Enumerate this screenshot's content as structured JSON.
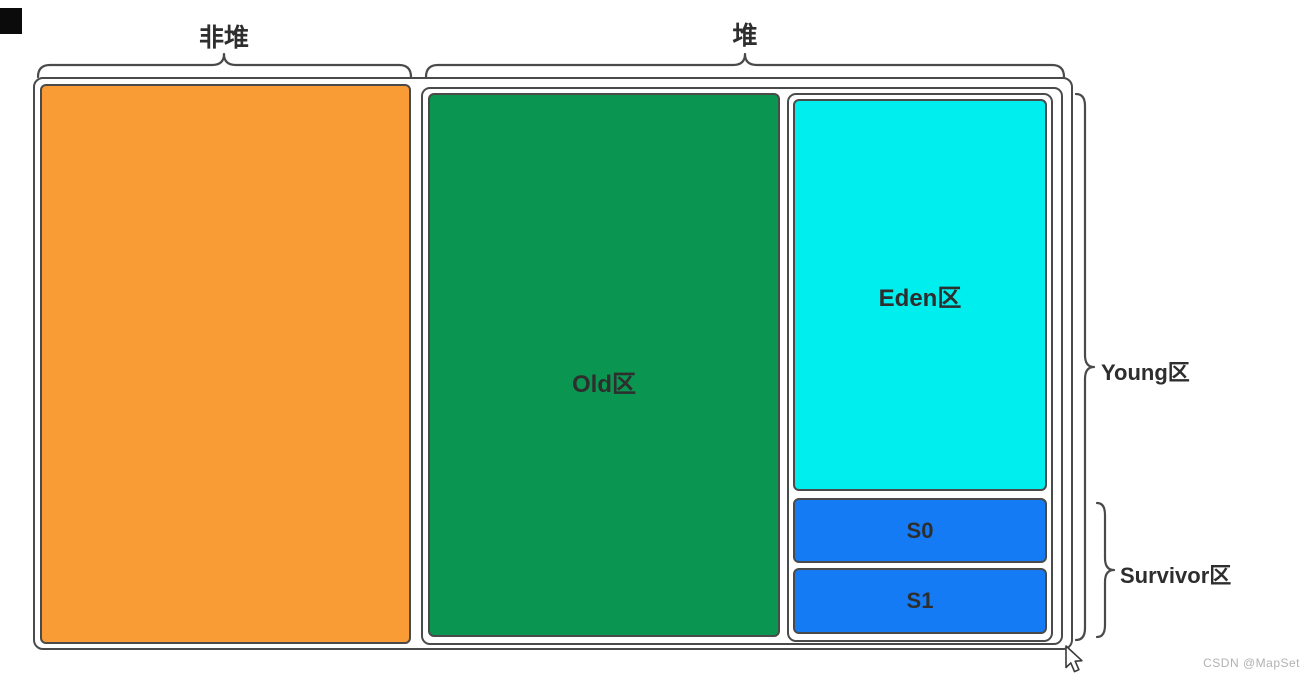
{
  "diagram": {
    "title_semantics": "JVM memory structure diagram",
    "top_braces": {
      "non_heap_label": "非堆",
      "heap_label": "堆"
    },
    "regions": {
      "old_label": "Old区",
      "eden_label": "Eden区",
      "s0_label": "S0",
      "s1_label": "S1"
    },
    "side_braces": {
      "young_label": "Young区",
      "survivor_label": "Survivor区"
    },
    "watermark": "CSDN @MapSet",
    "colors": {
      "non_heap_fill": "#FA9C36",
      "old_fill": "#0A9550",
      "eden_fill": "#00EEEE",
      "survivor_fill": "#157BF5",
      "container_fill": "#FFFFFF",
      "border": "#4A4A4A",
      "label_text": "#2E2E2E",
      "watermark_text": "#B3B1B1"
    }
  }
}
